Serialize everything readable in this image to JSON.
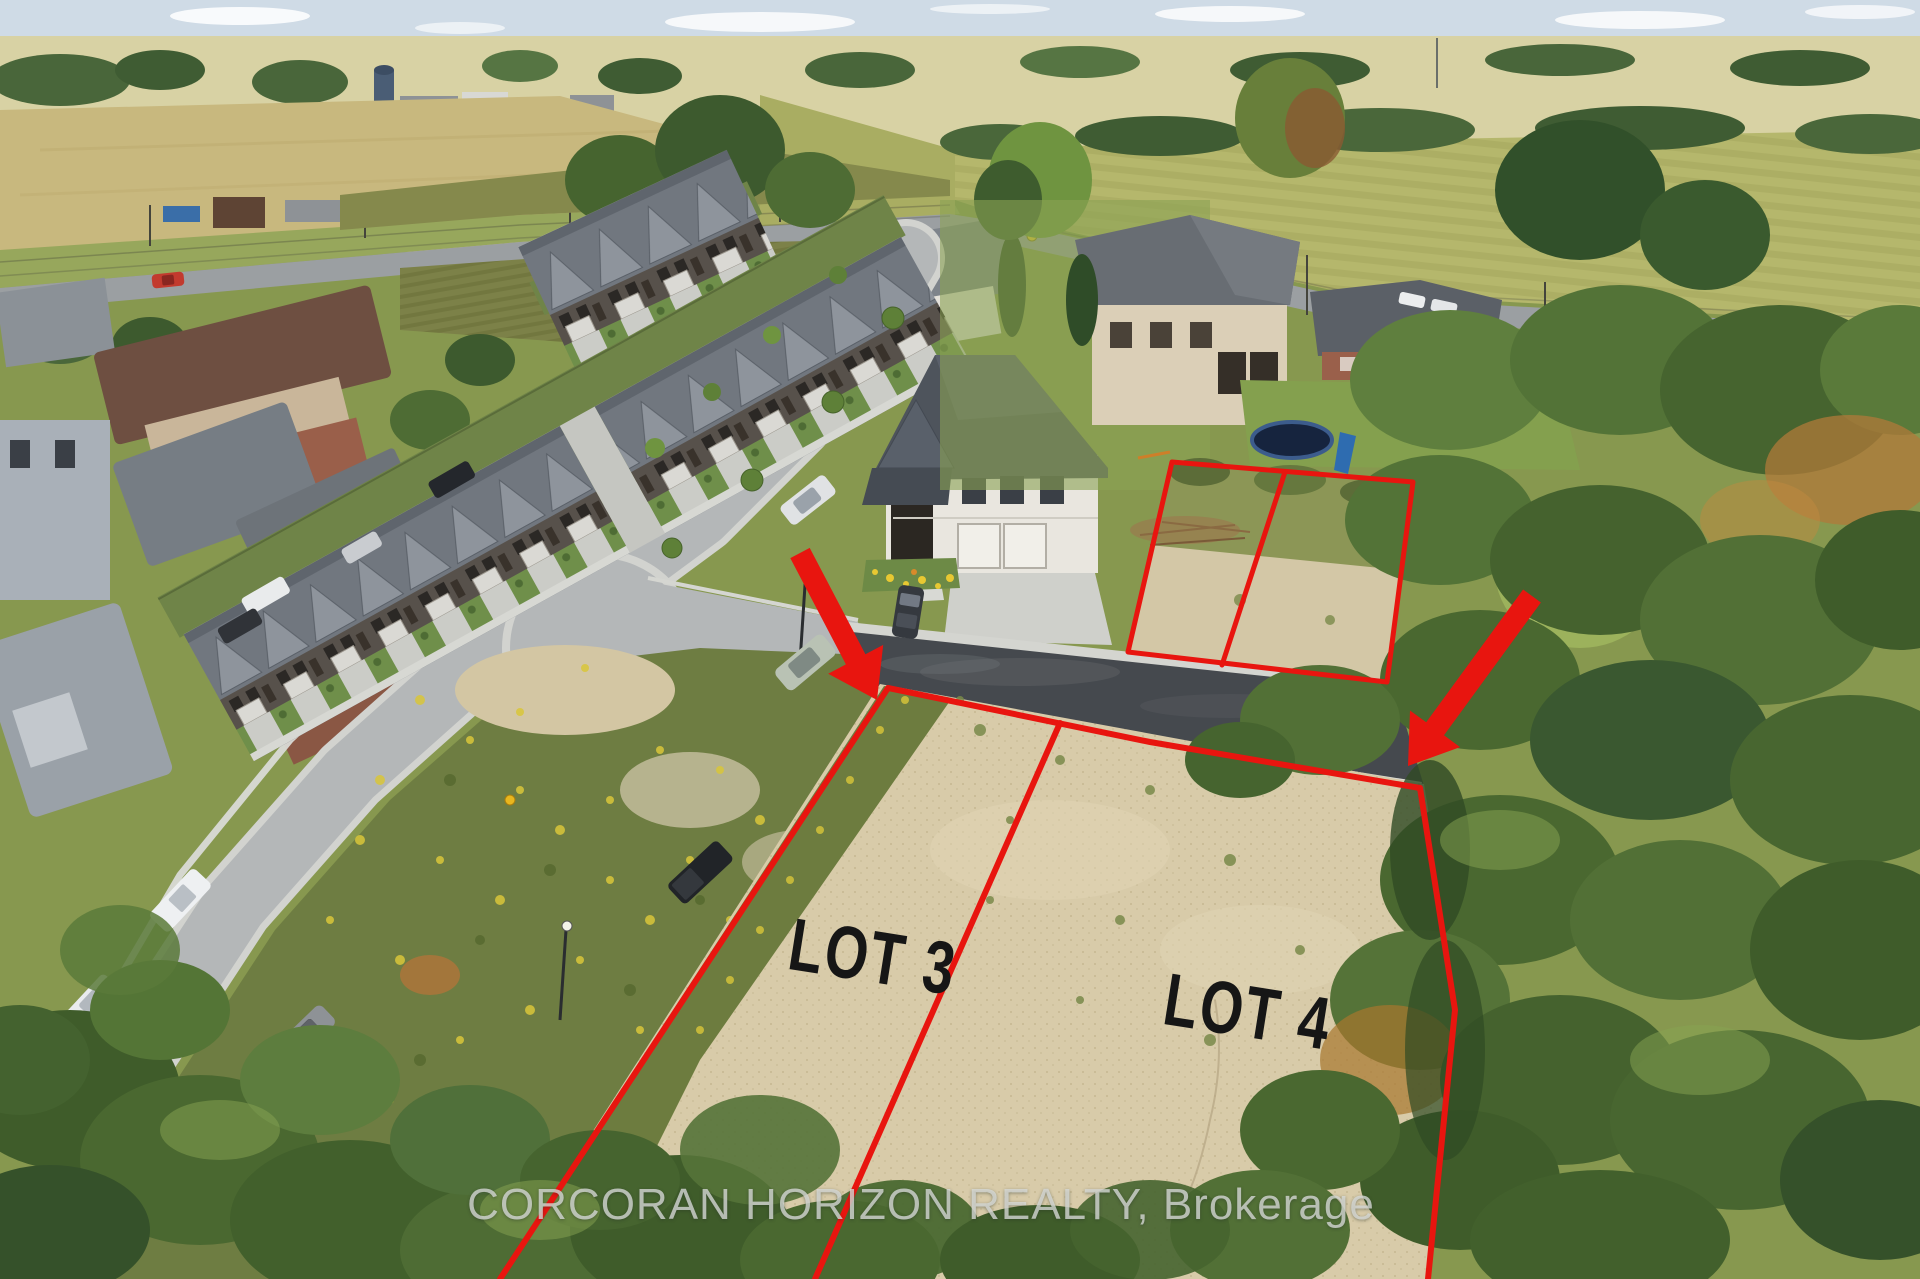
{
  "photo": {
    "type": "aerial-drone-photo",
    "purpose": "vacant-land-real-estate-listing"
  },
  "annotations": {
    "lots": [
      {
        "label": "LOT 3"
      },
      {
        "label": "LOT 4"
      }
    ],
    "watermark": "CORCORAN HORIZON REALTY, Brokerage",
    "outline_color": "#e8150f",
    "label_color": "#161616",
    "watermark_color": "#d8dbd8",
    "arrows": [
      {
        "name": "red-arrow-down-right-to-lot3"
      },
      {
        "name": "red-arrow-down-left-to-lot4"
      }
    ]
  },
  "scene_palette": {
    "sky": "#cfdbe6",
    "field_yellow_green": "#b5b76c",
    "crop_tan": "#c8b87e",
    "sand_lot": "#d8cba9",
    "fresh_asphalt": "#45494e",
    "street_gray": "#b4b7b8",
    "tree_green_dark": "#3f5c2a",
    "tree_green_mid": "#527036"
  }
}
